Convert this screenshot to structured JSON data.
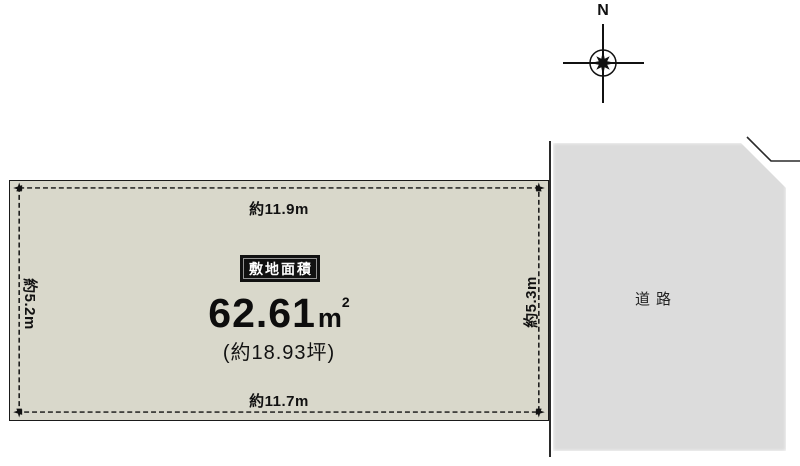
{
  "compass": {
    "north_label": "N"
  },
  "plot": {
    "fill_color": "#d9d8cb",
    "badge_color": "#111111",
    "area_badge": "敷地面積",
    "area_value": "62.61",
    "area_unit": "m",
    "area_unit_exp": "2",
    "area_tsubo": "(約18.93坪)",
    "dim_top": "約11.9m",
    "dim_bottom": "約11.7m",
    "dim_left": "約5.2m",
    "dim_right": "約5.3m"
  },
  "road": {
    "fill_color": "#dcdcdc",
    "label": "道路"
  },
  "line_color": "#1a1a1a"
}
